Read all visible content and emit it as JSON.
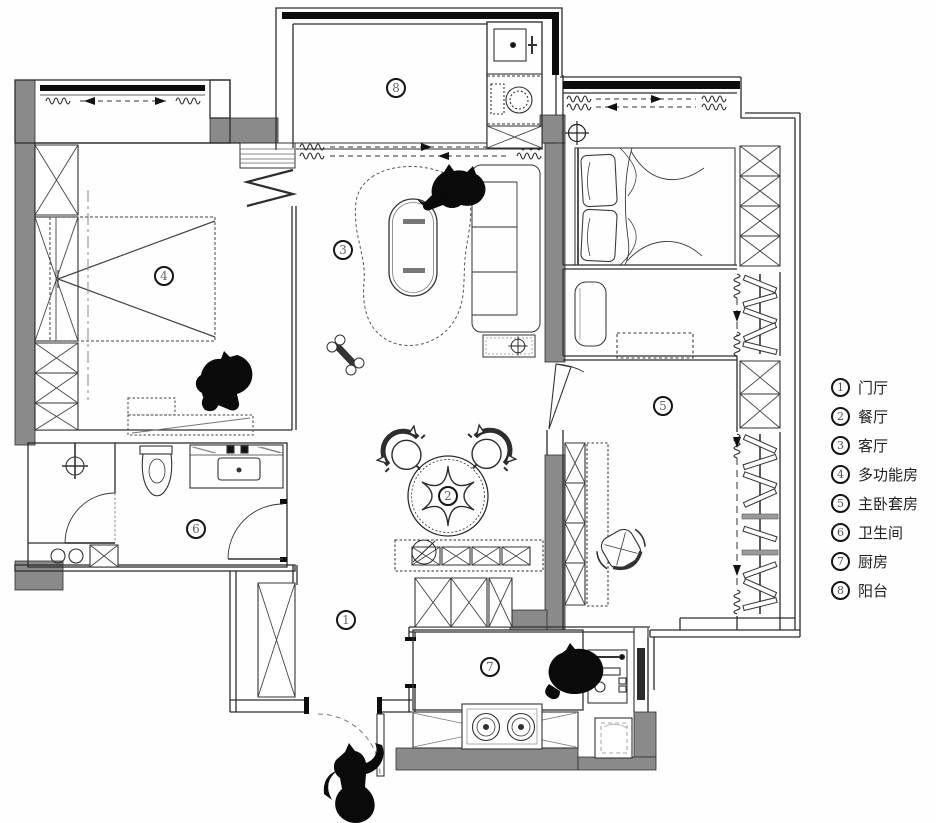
{
  "colors": {
    "wall": "#8a8a8a",
    "line": "#2d2d2d",
    "black": "#0c0c0c"
  },
  "legend": {
    "items": [
      {
        "num": "1",
        "label": "门厅"
      },
      {
        "num": "2",
        "label": "餐厅"
      },
      {
        "num": "3",
        "label": "客厅"
      },
      {
        "num": "4",
        "label": "多功能房"
      },
      {
        "num": "5",
        "label": "主卧套房"
      },
      {
        "num": "6",
        "label": "卫生间"
      },
      {
        "num": "7",
        "label": "厨房"
      },
      {
        "num": "8",
        "label": "阳台"
      }
    ]
  },
  "rooms": [
    {
      "num": "1",
      "name": "门厅",
      "x": 346,
      "y": 620
    },
    {
      "num": "2",
      "name": "餐厅",
      "x": 448,
      "y": 496
    },
    {
      "num": "3",
      "name": "客厅",
      "x": 343,
      "y": 250
    },
    {
      "num": "4",
      "name": "多功能房",
      "x": 164,
      "y": 276
    },
    {
      "num": "5",
      "name": "主卧套房",
      "x": 663,
      "y": 406
    },
    {
      "num": "6",
      "name": "卫生间",
      "x": 196,
      "y": 529
    },
    {
      "num": "7",
      "name": "厨房",
      "x": 490,
      "y": 667
    },
    {
      "num": "8",
      "name": "阳台",
      "x": 396,
      "y": 88
    }
  ]
}
